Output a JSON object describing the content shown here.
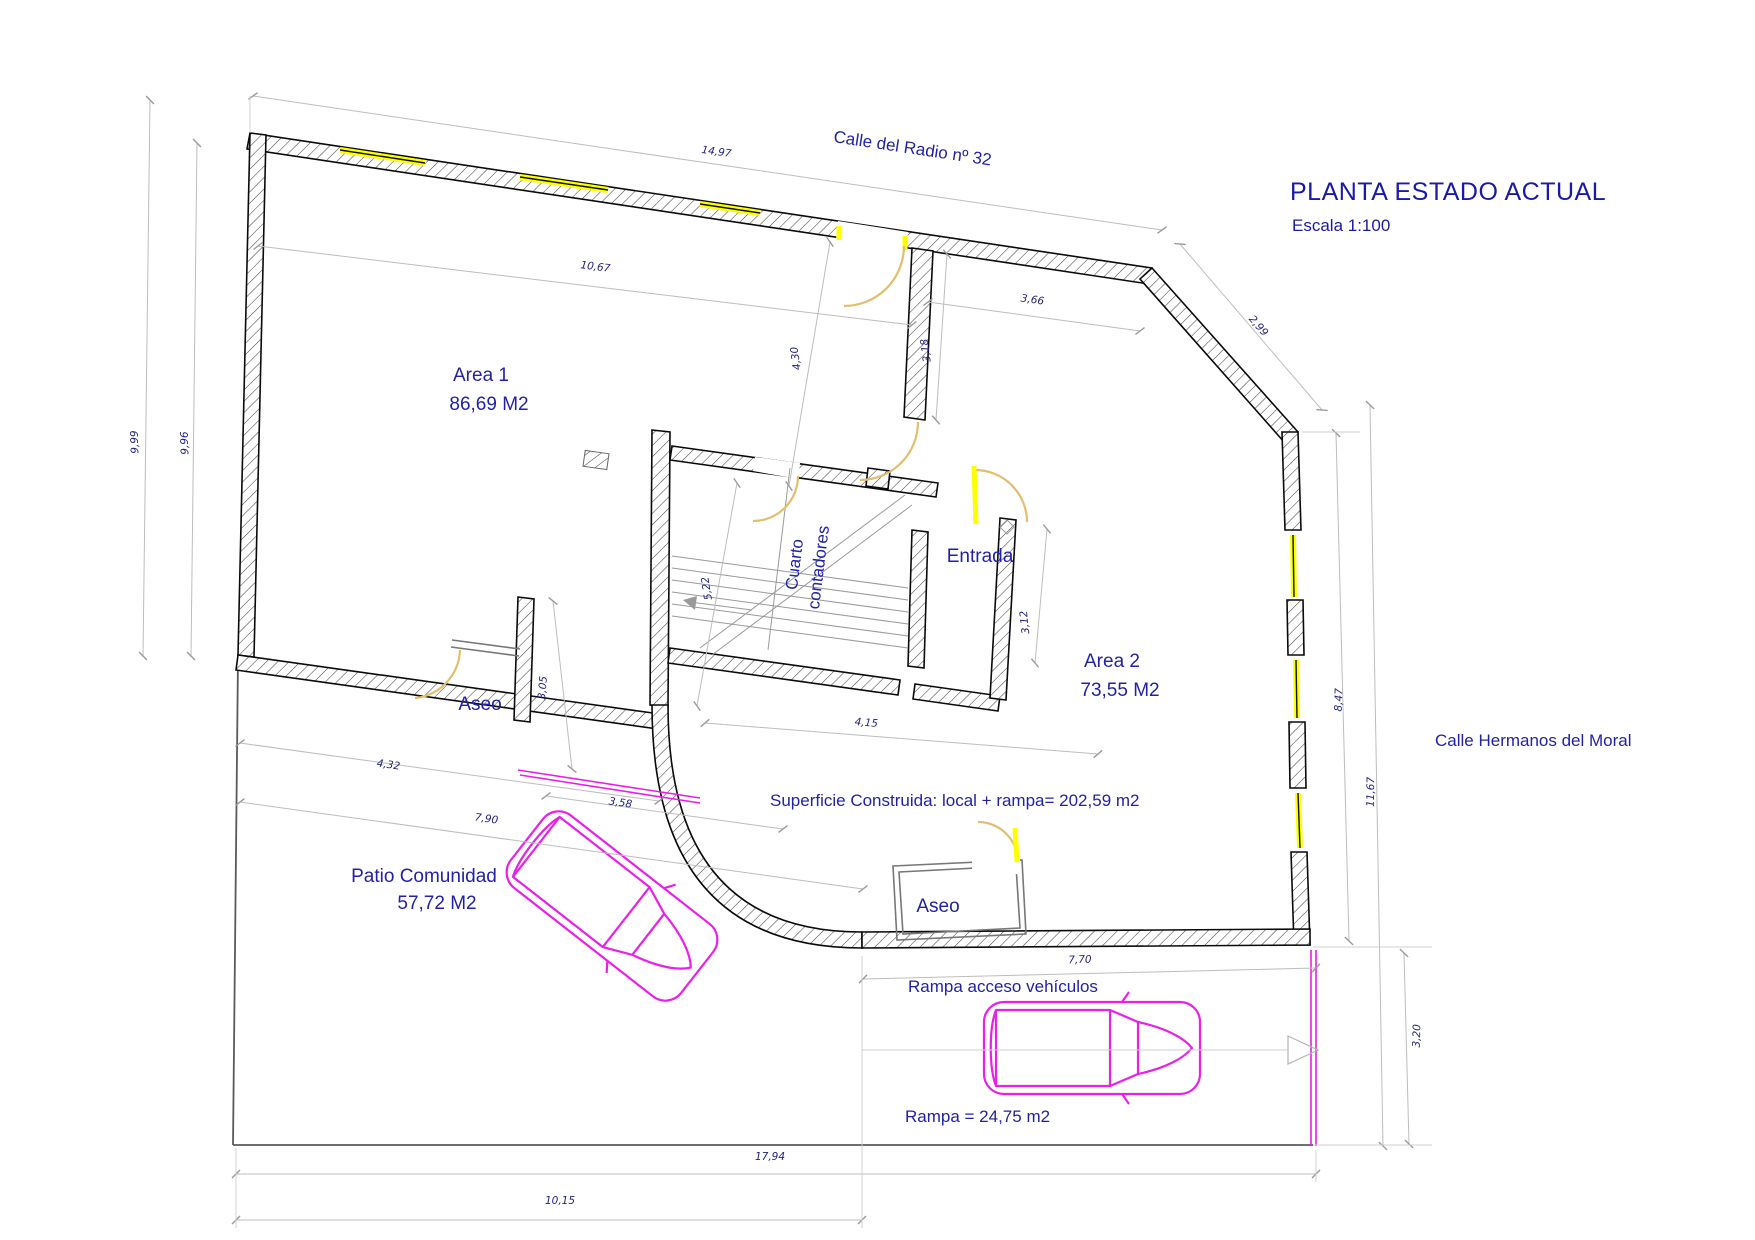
{
  "title": {
    "main": "PLANTA ESTADO ACTUAL",
    "scale": "Escala 1:100"
  },
  "streets": {
    "top": "Calle del Radio nº 32",
    "right": "Calle Hermanos del Moral"
  },
  "rooms": {
    "area1": {
      "name": "Area 1",
      "area": "86,69 M2"
    },
    "area2": {
      "name": "Area 2",
      "area": "73,55 M2"
    },
    "patio": {
      "name": "Patio Comunidad",
      "area": "57,72 M2"
    },
    "aseo1": "Aseo",
    "aseo2": "Aseo",
    "entrada": "Entrada",
    "cuarto_line1": "Cuarto",
    "cuarto_line2": "contadores"
  },
  "annotations": {
    "superficie": "Superficie Construida: local + rampa= 202,59 m2",
    "rampa_acceso": "Rampa acceso vehículos",
    "rampa_area": "Rampa = 24,75 m2"
  },
  "dims": {
    "top_width": "14,97",
    "area1_width": "10,67",
    "left_outer": "9,99",
    "left_inner": "9,96",
    "area2_top_width": "3,66",
    "chamfer": "2,99",
    "stub_height": "3,18",
    "area1_height_to_core": "4,30",
    "core_left": "5,22",
    "aseo1_wall": "3,05",
    "entrada_width": "3,12",
    "core_bottom": "4,15",
    "patio_top_a": "4,32",
    "patio_top_b": "3,58",
    "patio_top_total": "7,90",
    "right_upper": "8,47",
    "right_total": "11,67",
    "ramp_width": "7,70",
    "ramp_height": "3,20",
    "bottom_total": "17,94",
    "bottom_left": "10,15"
  },
  "colors": {
    "label_blue": "#2222a6",
    "dim_navy": "#23237d",
    "dim_grey": "#bdbdbd",
    "wall_black": "#0a0a0a",
    "window_yellow": "#ffff00",
    "door_tan": "#e2be6e",
    "car_magenta": "#ea1fea",
    "background": "#ffffff"
  }
}
